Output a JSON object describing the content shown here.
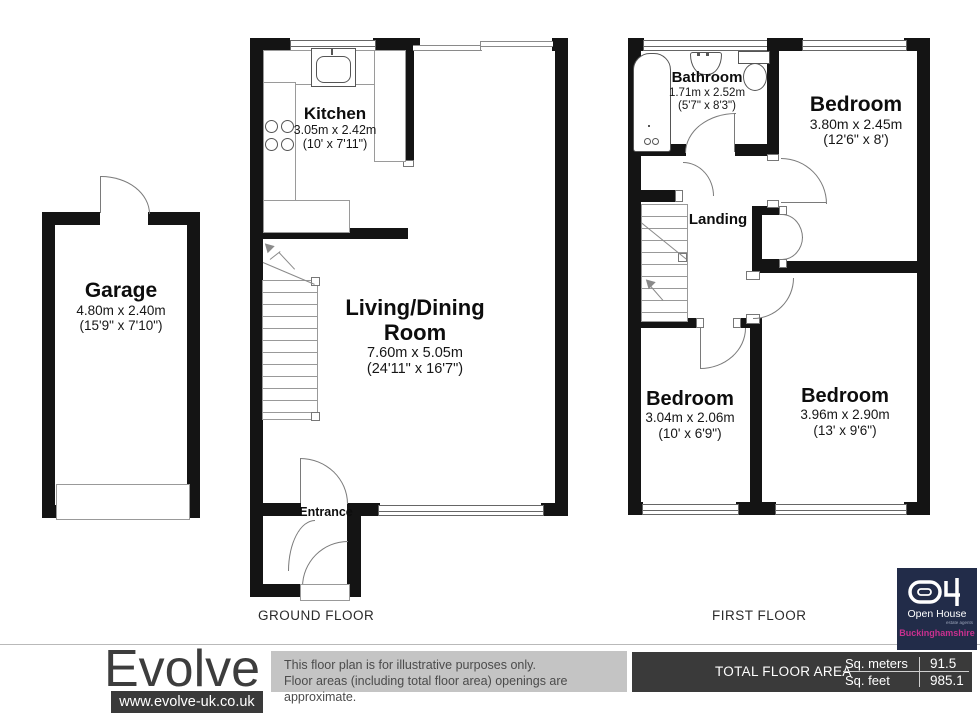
{
  "floors": {
    "ground_label": "GROUND FLOOR",
    "first_label": "FIRST FLOOR"
  },
  "rooms": {
    "garage": {
      "name": "Garage",
      "metric": "4.80m x 2.40m",
      "imperial": "(15'9\" x 7'10\")"
    },
    "kitchen": {
      "name": "Kitchen",
      "metric": "3.05m x 2.42m",
      "imperial": "(10' x 7'11\")"
    },
    "living": {
      "name": "Living/Dining",
      "name2": "Room",
      "metric": "7.60m x 5.05m",
      "imperial": "(24'11\" x 16'7\")"
    },
    "entrance": {
      "name": "Entrance"
    },
    "bathroom": {
      "name": "Bathroom",
      "metric": "1.71m x 2.52m",
      "imperial": "(5'7\" x 8'3\")"
    },
    "bedroom1": {
      "name": "Bedroom",
      "metric": "3.80m x 2.45m",
      "imperial": "(12'6\" x 8')"
    },
    "landing": {
      "name": "Landing"
    },
    "bedroom2": {
      "name": "Bedroom",
      "metric": "3.04m x 2.06m",
      "imperial": "(10' x 6'9\")"
    },
    "bedroom3": {
      "name": "Bedroom",
      "metric": "3.96m x 2.90m",
      "imperial": "(13' x 9'6\")"
    }
  },
  "footer": {
    "brand": "Evolve",
    "website": "www.evolve-uk.co.uk",
    "disclaimer_line1": "This floor plan is for illustrative purposes only.",
    "disclaimer_line2": "Floor areas (including total floor area) openings are approximate.",
    "total_label": "TOTAL FLOOR AREA",
    "sq_meters_label": "Sq. meters",
    "sq_meters_value": "91.5",
    "sq_feet_label": "Sq. feet",
    "sq_feet_value": "985.1"
  },
  "agency": {
    "logo_text": "Open House",
    "logo_subtext": "estate agents",
    "region": "Buckinghamshire",
    "brand_navy": "#222c49",
    "brand_magenta": "#c9308f"
  },
  "colors": {
    "wall": "#141414",
    "line": "#8a8a8a",
    "footer_dark": "#3a3a3a",
    "disclaimer_bg": "#c4c4c4"
  }
}
